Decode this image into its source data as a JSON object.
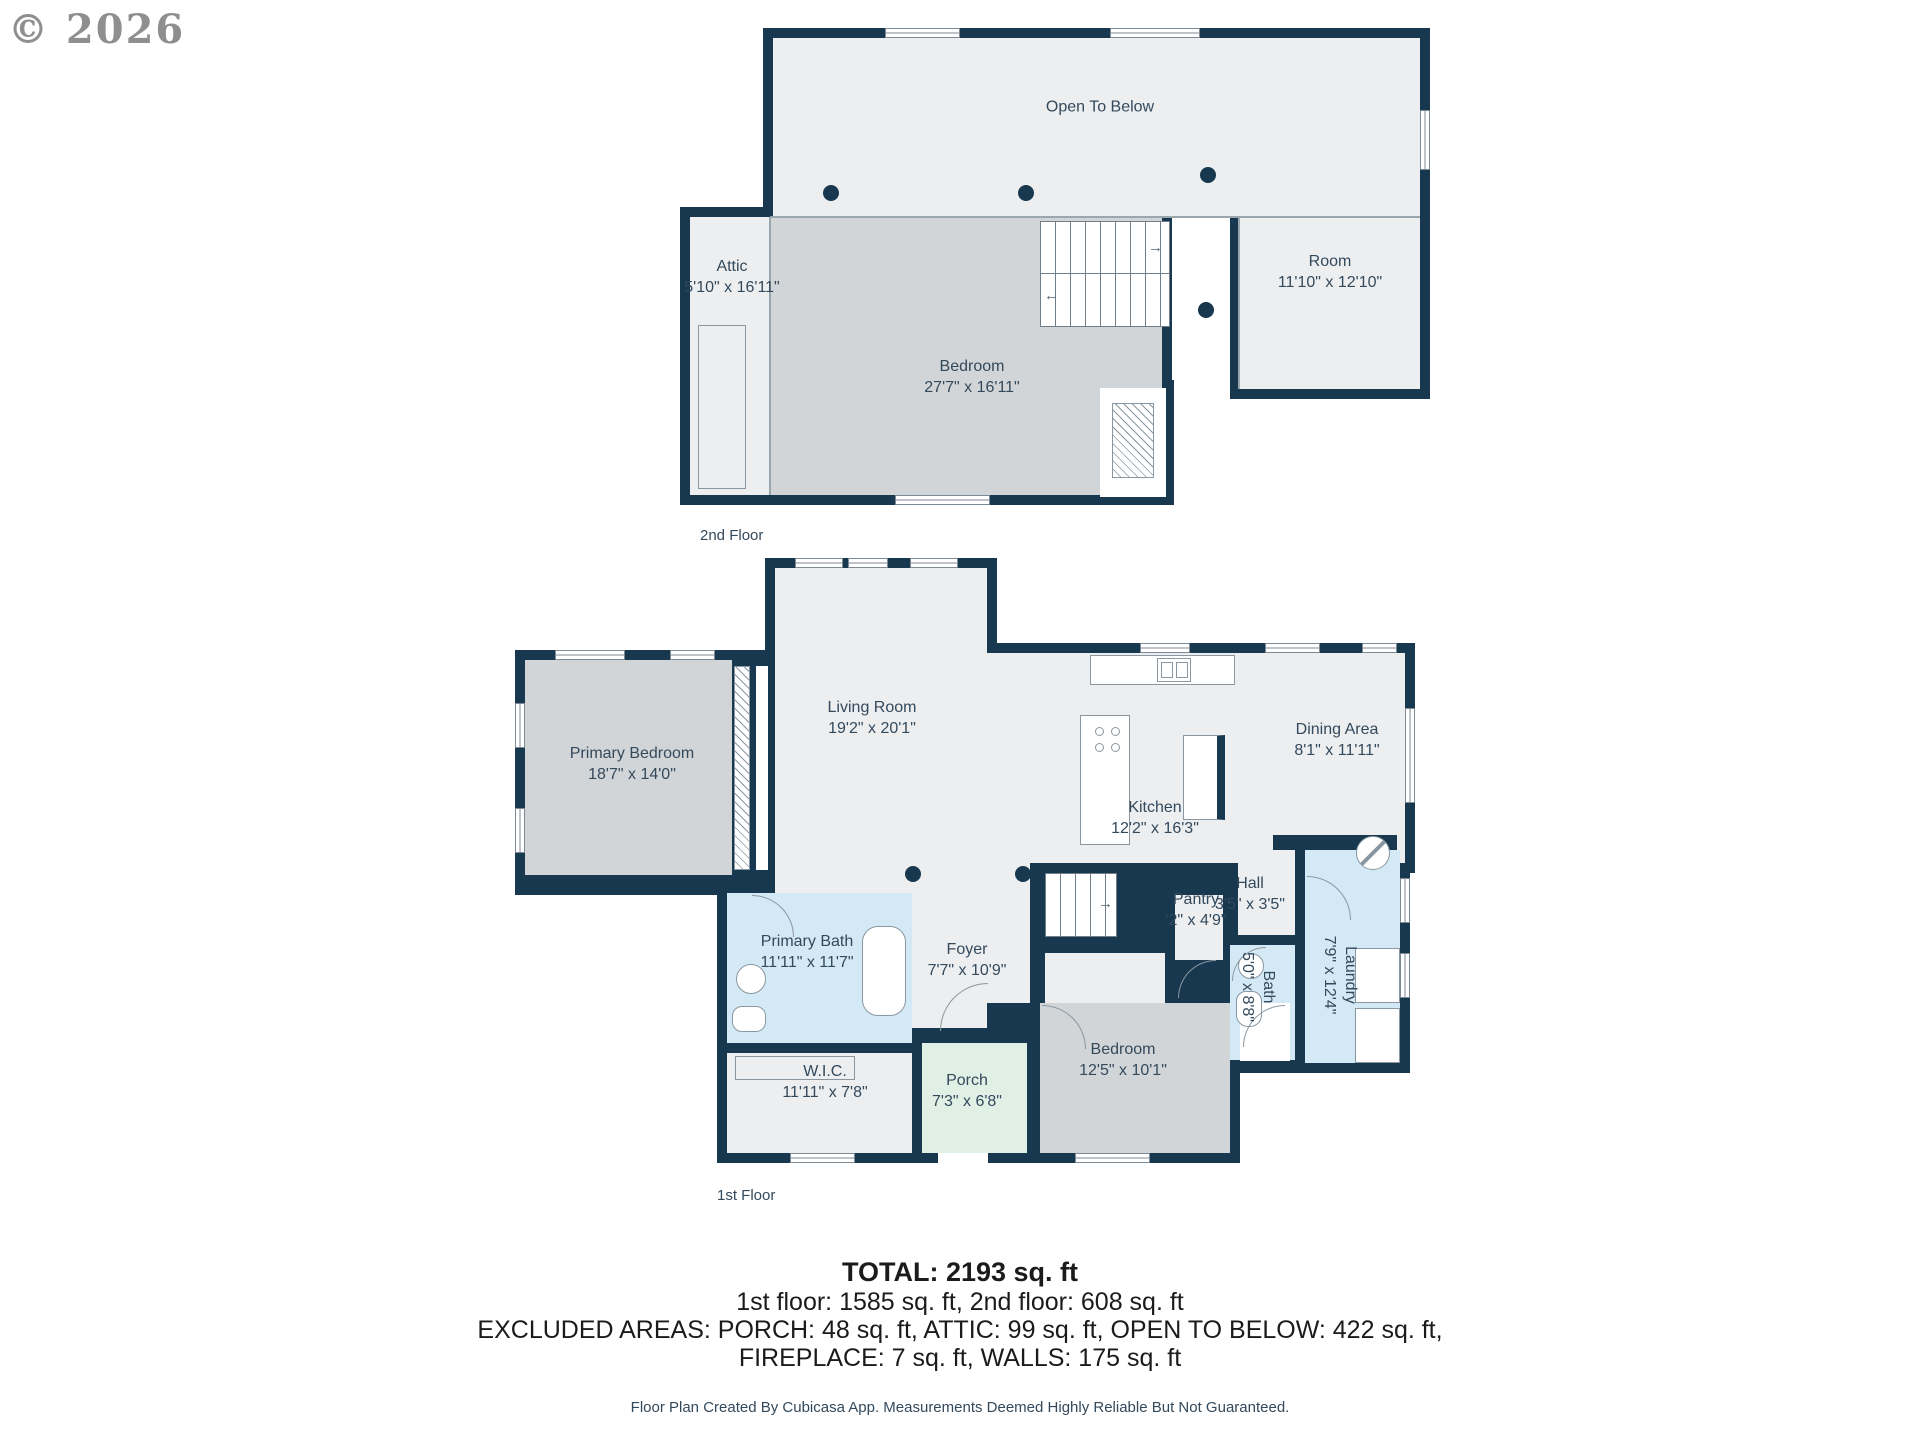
{
  "watermark": "© 2026",
  "icons": {
    "arrow_right": "→",
    "arrow_left": "←",
    "arrow_up": "↑"
  },
  "floor2": {
    "label": "2nd Floor",
    "rooms": {
      "open_to_below": {
        "label": "Open To Below"
      },
      "attic": {
        "label": "Attic",
        "dims": "5'10\" x 16'11\""
      },
      "bedroom": {
        "label": "Bedroom",
        "dims": "27'7\" x 16'11\""
      },
      "room": {
        "label": "Room",
        "dims": "11'10\" x 12'10\""
      }
    }
  },
  "floor1": {
    "label": "1st Floor",
    "rooms": {
      "primary_bedroom": {
        "label": "Primary Bedroom",
        "dims": "18'7\" x 14'0\""
      },
      "living_room": {
        "label": "Living Room",
        "dims": "19'2\" x 20'1\""
      },
      "dining_area": {
        "label": "Dining Area",
        "dims": "8'1\" x 11'11\""
      },
      "kitchen": {
        "label": "Kitchen",
        "dims": "12'2\" x 16'3\""
      },
      "pantry": {
        "label": "Pantry",
        "dims": "'2\" x 4'9\""
      },
      "hall": {
        "label": "Hall",
        "dims": "3'5\" x 3'5\""
      },
      "foyer": {
        "label": "Foyer",
        "dims": "7'7\" x 10'9\""
      },
      "primary_bath": {
        "label": "Primary Bath",
        "dims": "11'11\" x 11'7\""
      },
      "wic": {
        "label": "W.I.C.",
        "dims": "11'11\" x 7'8\""
      },
      "porch": {
        "label": "Porch",
        "dims": "7'3\" x 6'8\""
      },
      "bedroom": {
        "label": "Bedroom",
        "dims": "12'5\" x 10'1\""
      },
      "bath": {
        "label": "Bath",
        "dims": "5'0\" x 8'8\""
      },
      "laundry": {
        "label": "Laundry",
        "dims": "7'9\" x 12'4\""
      }
    }
  },
  "summary": {
    "total": "TOTAL: 2193 sq. ft",
    "floors": "1st floor: 1585 sq. ft, 2nd floor: 608 sq. ft",
    "excluded1": "EXCLUDED AREAS: PORCH: 48 sq. ft, ATTIC: 99 sq. ft, OPEN TO BELOW: 422 sq. ft,",
    "excluded2": "FIREPLACE: 7 sq. ft, WALLS: 175 sq. ft",
    "footer": "Floor Plan Created By Cubicasa App. Measurements Deemed Highly Reliable But Not Guaranteed."
  },
  "colors": {
    "wall": "#17384E",
    "room_light": "#ECEEF0",
    "room_gray": "#D2D5D7",
    "room_blue": "#D4E9F6",
    "room_green": "#E1F0E5",
    "label_text": "#33495C"
  }
}
